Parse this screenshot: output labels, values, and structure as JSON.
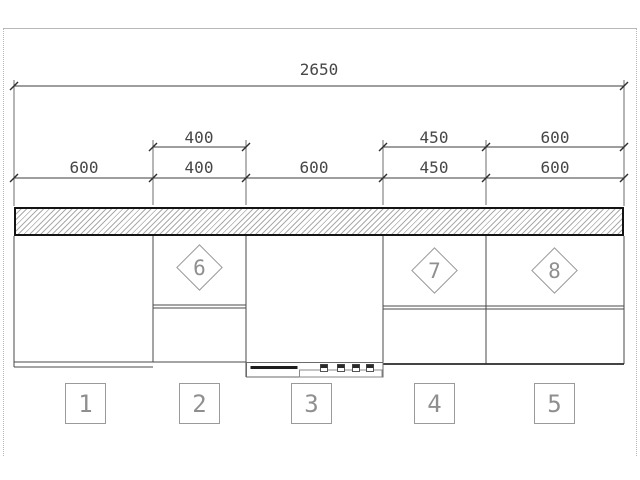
{
  "colors": {
    "line": "#4a4a4a",
    "dim": "#474747",
    "label": "#8f8f8f",
    "frame": "#b8b8b8",
    "hatch-line": "#ababab",
    "hatch-border": "#141414",
    "marker-border": "#9a9a9a"
  },
  "dimensions": {
    "overall": {
      "label": "2650"
    },
    "row2": [
      {
        "label": "400"
      },
      {
        "label": "450"
      },
      {
        "label": "600"
      }
    ],
    "row3": [
      {
        "label": "600"
      },
      {
        "label": "400"
      },
      {
        "label": "600"
      },
      {
        "label": "450"
      },
      {
        "label": "600"
      }
    ]
  },
  "unit_markers": [
    {
      "label": "6"
    },
    {
      "label": "7"
    },
    {
      "label": "8"
    }
  ],
  "position_markers": [
    {
      "label": "1"
    },
    {
      "label": "2"
    },
    {
      "label": "3"
    },
    {
      "label": "4"
    },
    {
      "label": "5"
    }
  ]
}
